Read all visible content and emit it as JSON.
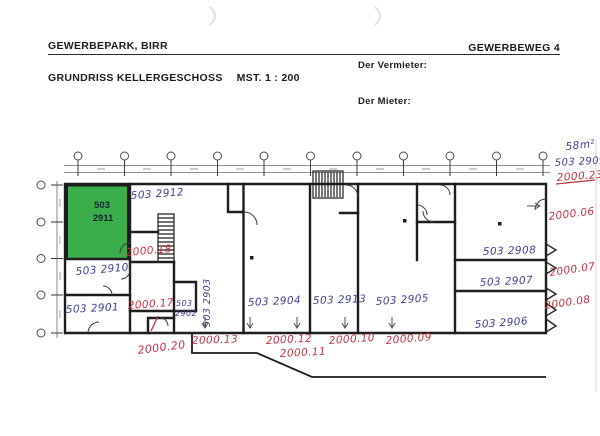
{
  "doc": {
    "park": "GEWERBEPARK, BIRR",
    "street": "GEWERBEWEG 4",
    "title": "GRUNDRISS KELLERGESCHOSS",
    "scale": "MST. 1 : 200",
    "vermieter": "Der Vermieter:",
    "mieter": "Der Mieter:"
  },
  "rooms": {
    "r2911_l1": "503",
    "r2911_l2": "2911",
    "r2912": "503 2912",
    "r2910": "503 2910",
    "r2901": "503 2901",
    "r2902_l1": "503",
    "r2902_l2": "2902",
    "r2903": "503 2903",
    "r2904": "503 2904",
    "r2905": "503 2905",
    "r2906": "503 2906",
    "r2907": "503 2907",
    "r2908": "503 2908",
    "r2909": "503 2909",
    "r2913": "503 2913",
    "area_note": "58m²"
  },
  "marks": {
    "m06": "2000.06",
    "m07": "2000.07",
    "m08": "2000.08",
    "m09": "2000.09",
    "m10": "2000.10",
    "m11": "2000.11",
    "m12": "2000.12",
    "m13": "2000.13",
    "m17": "2000.17",
    "m18": "2000.18",
    "m20": "2000.20",
    "m23": "2000.23"
  },
  "colors": {
    "ink_blue": "#3f3f94",
    "ink_red": "#c63341",
    "wall": "#1d1d1d",
    "highlight_green": "#3cad4b"
  }
}
